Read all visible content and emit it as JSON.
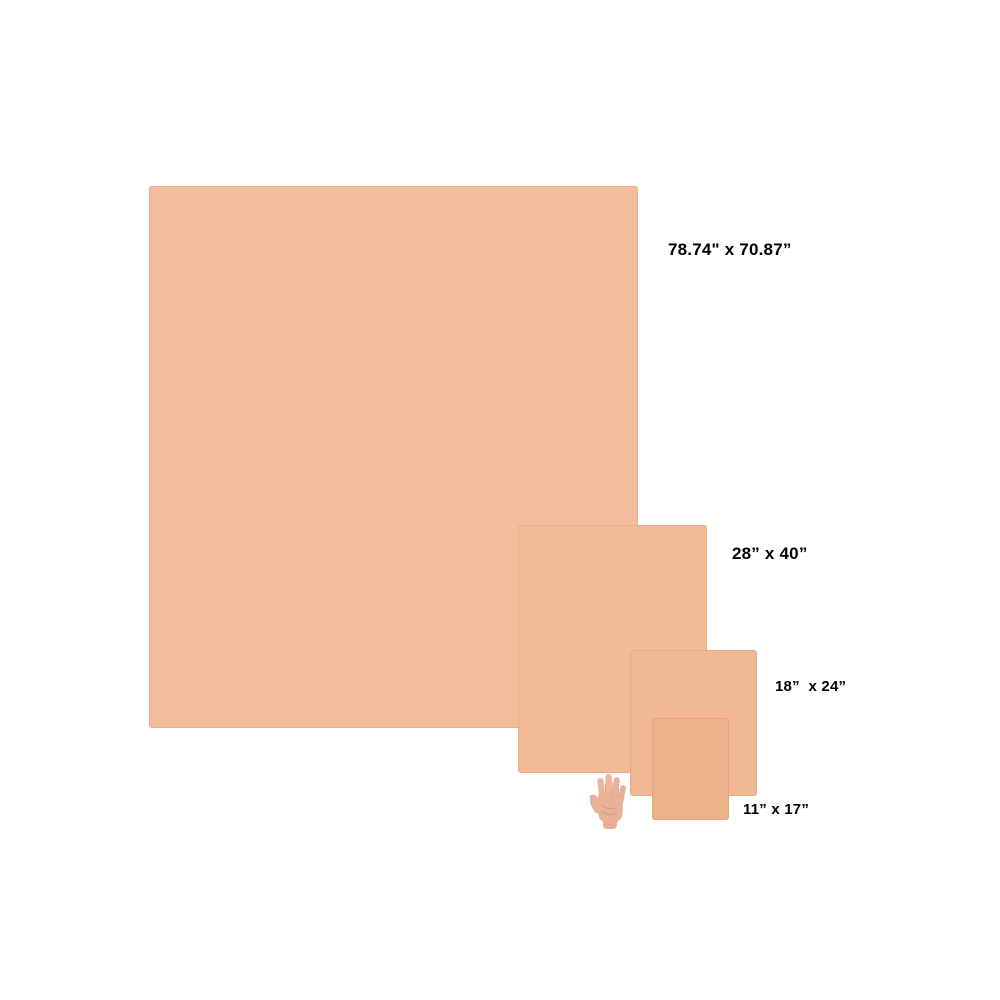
{
  "diagram": {
    "description": "Sheet size comparison with hand for scale",
    "background_color": "#ffffff",
    "label_color": "#000000",
    "items": [
      {
        "label": "78.74\" x 70.87”",
        "width_in": 78.74,
        "height_in": 70.87,
        "color": "#f2bd9a"
      },
      {
        "label": "28” x 40”",
        "width_in": 28,
        "height_in": 40,
        "color": "#f2bc98"
      },
      {
        "label": "18”  x 24”",
        "width_in": 18,
        "height_in": 24,
        "color": "#f0b893"
      },
      {
        "label": "11” x 17”",
        "width_in": 11,
        "height_in": 17,
        "color": "#edb18c"
      }
    ],
    "hand": {
      "icon": "hand-for-scale-icon",
      "skin_color": "#e9b198"
    }
  }
}
